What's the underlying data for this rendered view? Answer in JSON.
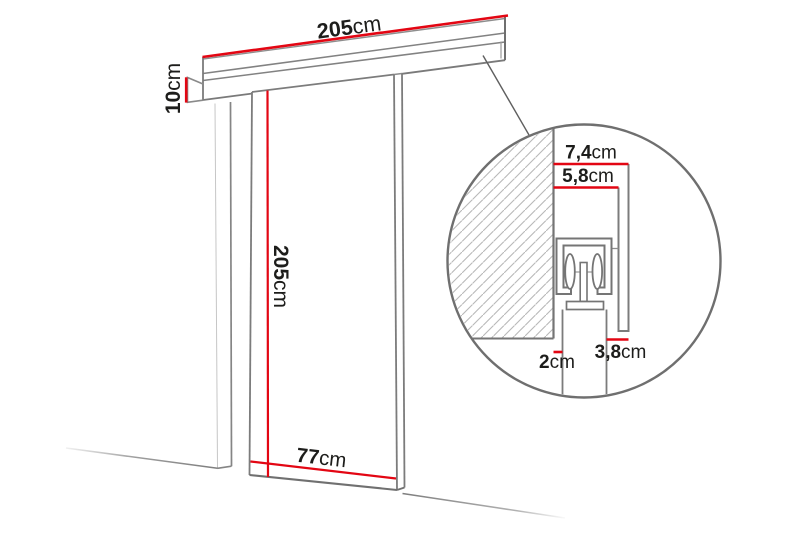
{
  "diagram": {
    "type": "sliding-door-dimension-diagram",
    "dimensions": {
      "rail_length": {
        "value": "205",
        "unit": "cm"
      },
      "rail_height": {
        "value": "10",
        "unit": "cm"
      },
      "door_height": {
        "value": "205",
        "unit": "cm"
      },
      "door_width": {
        "value": "77",
        "unit": "cm"
      },
      "detail_total_depth": {
        "value": "7,4",
        "unit": "cm"
      },
      "detail_track_depth": {
        "value": "5,8",
        "unit": "cm"
      },
      "detail_door_offset": {
        "value": "3,8",
        "unit": "cm"
      },
      "detail_wall_gap": {
        "value": "2",
        "unit": "cm"
      }
    },
    "colors": {
      "dimension_line_red": "#e30613",
      "outline_gray": "#7c7c7c",
      "hatch_gray": "#b8b8b8",
      "text_color": "#1d1d1b",
      "background": "#ffffff"
    }
  }
}
